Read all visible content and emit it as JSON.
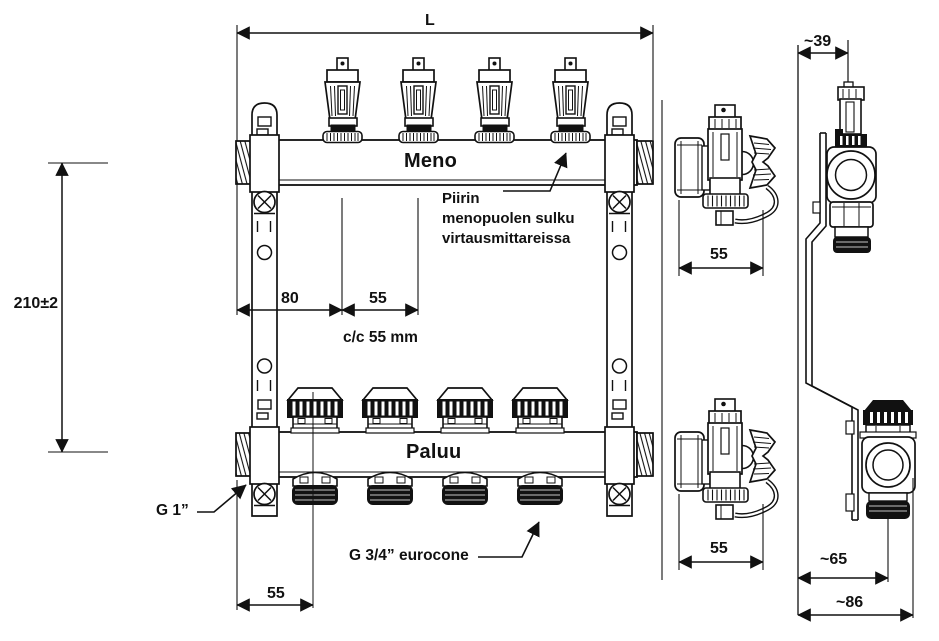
{
  "drawing": {
    "front": {
      "length_dim": "L",
      "height_dim": "210±2",
      "supply_label": "Meno",
      "return_label": "Paluu",
      "note_line1": "Piirin",
      "note_line2": "menopuolen sulku",
      "note_line3": "virtausmittareissa",
      "dim_80": "80",
      "dim_55": "55",
      "cc_spacing": "c/c 55 mm",
      "dim_55_end": "55",
      "g1_label": "G 1”",
      "g34_label": "G 3/4” eurocone"
    },
    "side": {
      "dim_55_supply": "55",
      "dim_55_return": "55"
    },
    "profile": {
      "dim_39": "~39",
      "dim_65": "~65",
      "dim_86": "~86"
    }
  }
}
